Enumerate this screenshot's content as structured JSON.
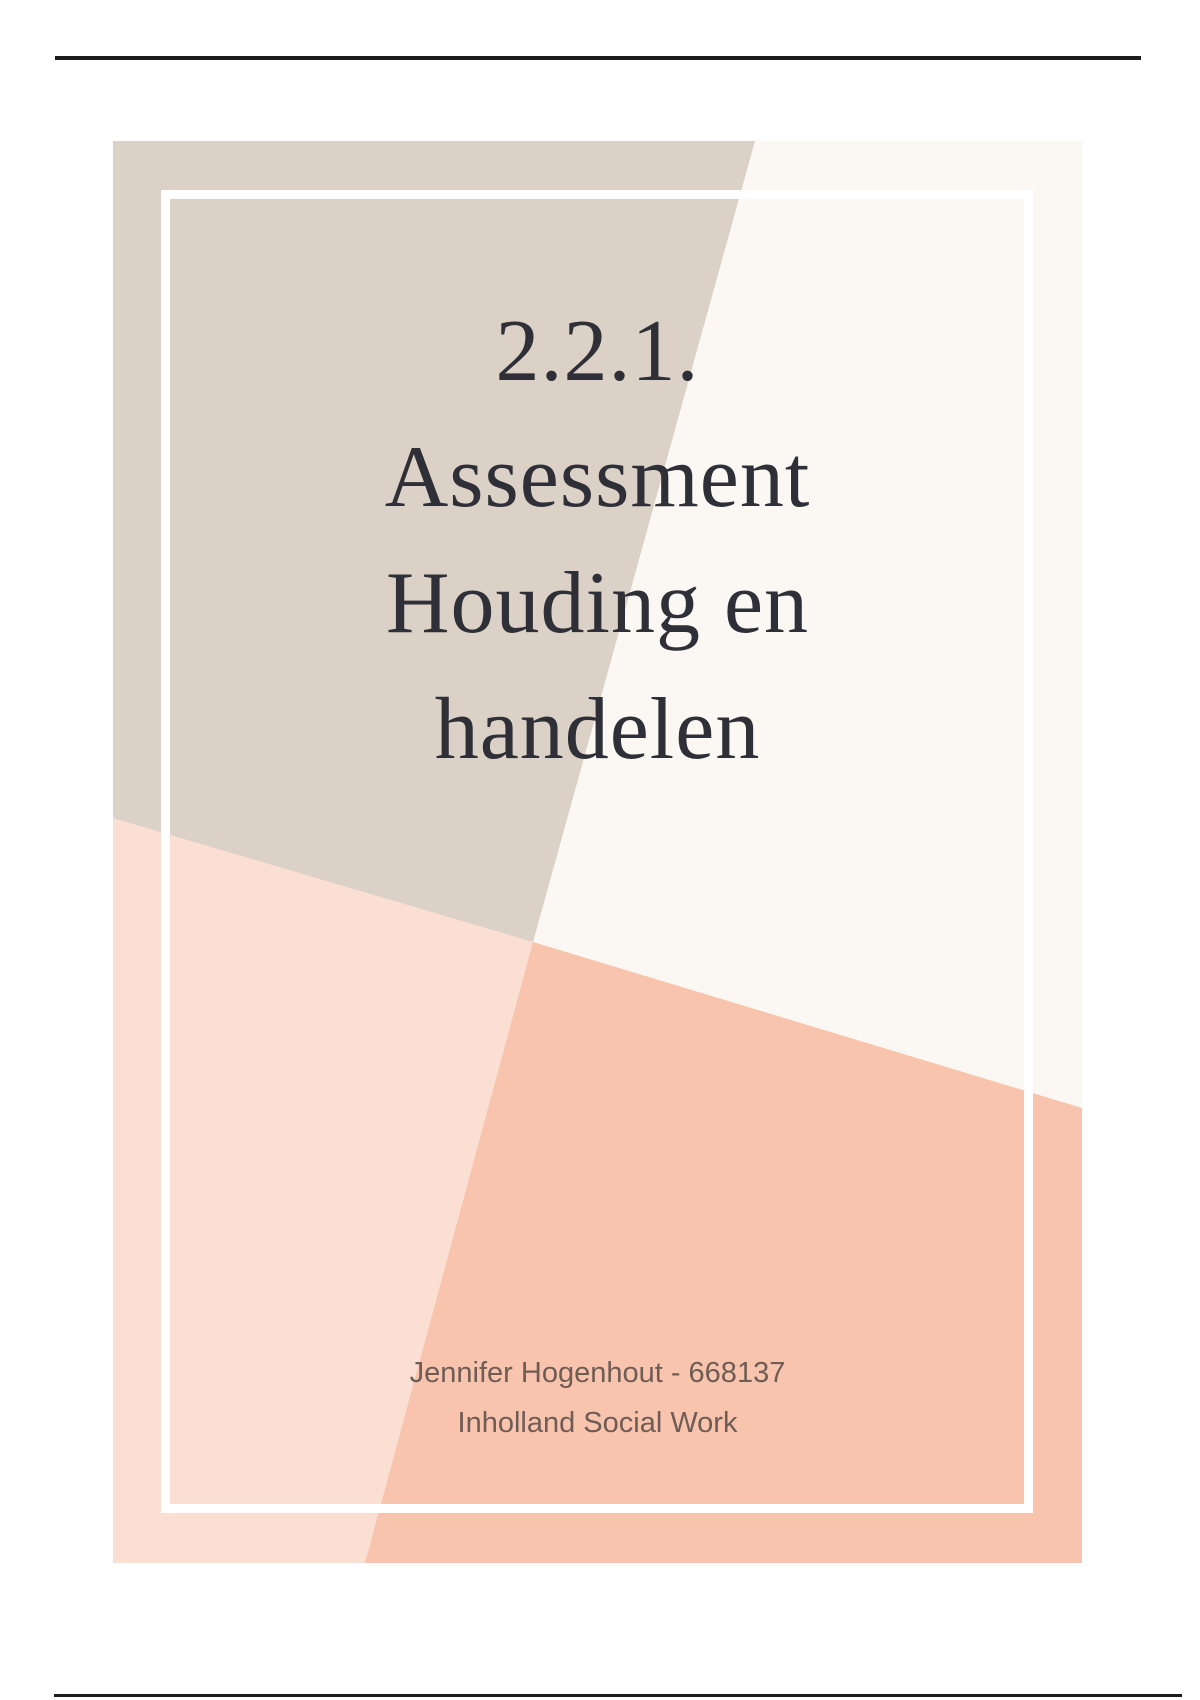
{
  "page": {
    "background": "#ffffff",
    "rule_color": "#1d1d1d"
  },
  "cover": {
    "title_lines": [
      "2.2.1.",
      "Assessment",
      "Houding en",
      "handelen"
    ],
    "author_line1": "Jennifer Hogenhout - 668137",
    "author_line2": "Inholland Social Work",
    "colors": {
      "beige": "#dbd1c6",
      "offwhite": "#fbf8f3",
      "pink": "#fcdfd3",
      "salmon": "#f9c4ae",
      "frame": "#ffffff",
      "title_text": "#2f2f38",
      "author_text": "#6f5c55"
    }
  }
}
